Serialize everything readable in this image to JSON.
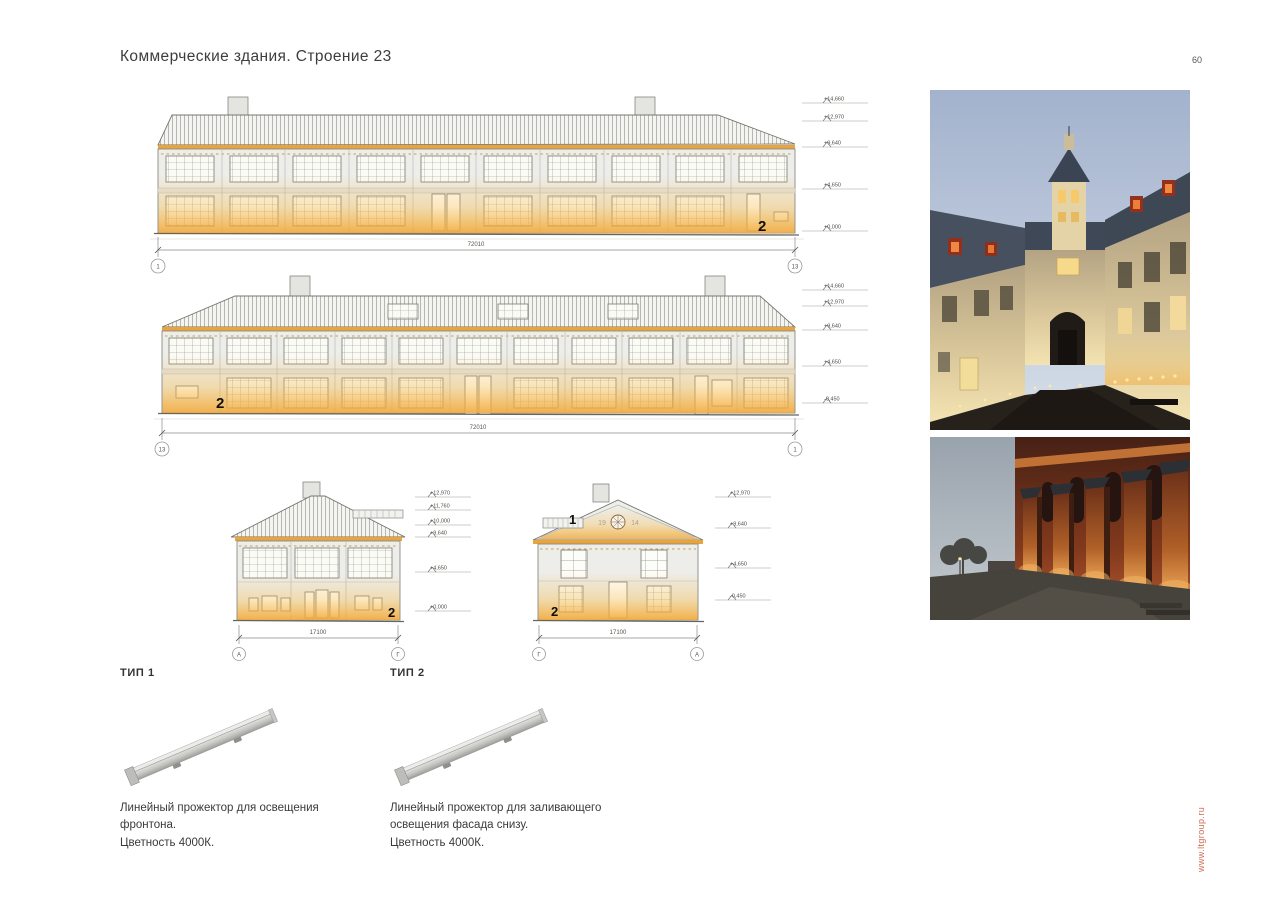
{
  "page": {
    "title": "Коммерческие здания. Строение 23",
    "number": "60",
    "site_url": "www.ltgroup.ru"
  },
  "colors": {
    "facade_glow": "#F2A83A",
    "cornice_light": "#E9A43C",
    "url_text": "#CF6B50"
  },
  "drawings": {
    "long_elevation_front": {
      "levels": [
        "+14,660",
        "+12,970",
        "+9,640",
        "+4,650",
        "+0,000"
      ],
      "dimension": "72010",
      "axis_left": "1",
      "axis_right": "13",
      "marker": "2"
    },
    "long_elevation_back": {
      "levels": [
        "+14,660",
        "+12,970",
        "+9,640",
        "+4,650",
        "-0,450"
      ],
      "dimension": "72010",
      "axis_left": "13",
      "axis_right": "1",
      "marker": "2"
    },
    "end_elevation_left": {
      "levels": [
        "+12,970",
        "+11,760",
        "+10,000",
        "+9,640",
        "+4,650",
        "+0,000"
      ],
      "dimension": "17100",
      "axis_left": "А",
      "axis_right": "Г",
      "marker": "2"
    },
    "end_elevation_right": {
      "levels": [
        "+12,970",
        "+9,640",
        "+4,650",
        "-0,450"
      ],
      "dimension": "17100",
      "axis_left": "Г",
      "axis_right": "А",
      "marker_gable": "1",
      "marker_base": "2",
      "gable_year_left": "19",
      "gable_year_right": "14"
    }
  },
  "products": [
    {
      "type_label": "ТИП 1",
      "description_lines": [
        "Линейный прожектор для освещения",
        "фронтона.",
        "Цветность 4000К."
      ]
    },
    {
      "type_label": "ТИП 2",
      "description_lines": [
        "Линейный прожектор для заливающего",
        "освещения фасада снизу.",
        "Цветность 4000К."
      ]
    }
  ]
}
